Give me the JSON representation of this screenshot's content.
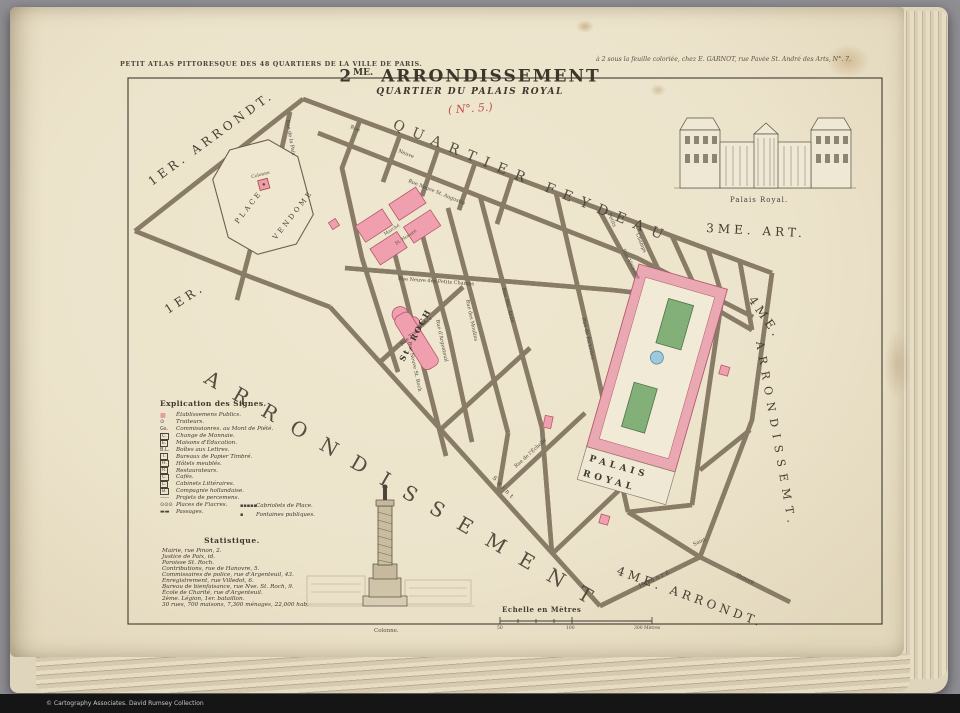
{
  "colors": {
    "paper": "#ece3cb",
    "building_pink": "#ef9fae",
    "garden_green": "#83b078",
    "basin_blue": "#9cc9dd",
    "annotation_red": "#c05050"
  },
  "photo": {
    "copyright": "© Cartography Associates. David Rumsey Collection"
  },
  "header": {
    "left": "PETIT ATLAS PITTORESQUE DES 48 QUARTIERS DE LA VILLE DE PARIS.",
    "right": "à 2 sous la feuille coloriée, chez E. GARNOT, rue Pavée St. André des Arts, N°. 7."
  },
  "title": {
    "num": "2",
    "sup": "ME.",
    "name": "ARRONDISSEMENT",
    "subtitle": "QUARTIER DU PALAIS ROYAL",
    "annotation": "( N°. 5.)"
  },
  "engravings": {
    "palais_caption": "Palais Royal.",
    "colonne_caption": "Colonne."
  },
  "map": {
    "district_labels": {
      "arr1_top": "1ER. ARRONDT.",
      "arr1_mid": "1ER.",
      "quartier": "QUARTIER FEYDEAU",
      "arr3": "3ME.  ART.",
      "arr4_num": "4ME.",
      "arr4_side": "ARRONDISSEMT.",
      "arr4_bottom": "4ME. ARRONDT.",
      "big": "ARRONDISSEMENT"
    },
    "places": {
      "place_vendome_1": "PLACE",
      "place_vendome_2": "VENDOME",
      "colonne": "Colonne",
      "marche_1": "Marché",
      "marche_2": "St. Honoré",
      "st_roch": "St. ROCH",
      "palais_1": "PALAIS",
      "palais_2": "ROYAL"
    },
    "street_labels": [
      {
        "t": "Rue de la Paix"
      },
      {
        "t": "Rue Neuve St. Augustin"
      },
      {
        "t": "Rue Neuve des Petits Champs"
      },
      {
        "t": "Rue de Richelieu"
      },
      {
        "t": "Rue Ste. Anne"
      },
      {
        "t": "Rue d'Argenteuil"
      },
      {
        "t": "Rue Neuve St. Roch"
      },
      {
        "t": "Rue des Moulins"
      },
      {
        "t": "Saint"
      },
      {
        "t": "Honoré"
      },
      {
        "t": "Rue"
      },
      {
        "t": "Neuve"
      },
      {
        "t": "Petits"
      },
      {
        "t": "Champs"
      },
      {
        "t": "Rue Vivienne"
      },
      {
        "t": "Rue de l'Échelle"
      },
      {
        "t": "Rue Traversière"
      },
      {
        "t": "Saint"
      },
      {
        "t": "Honoré"
      }
    ]
  },
  "legend": {
    "title": "Explication des Signes.",
    "items": [
      {
        "symbol": "■",
        "label": "Établissemens Publics."
      },
      {
        "symbol": "⊙",
        "label": "Traiteurs."
      },
      {
        "symbol": "Gs.",
        "label": "Commissionres. au Mont de Piété."
      },
      {
        "symbol": "C.",
        "label": "Change de Monnaie."
      },
      {
        "symbol": "E.",
        "label": "Maisons d'Éducation."
      },
      {
        "symbol": "B.L.",
        "label": "Boîtes aux Lettres."
      },
      {
        "symbol": "T.",
        "label": "Bureaux de Papier Timbré."
      },
      {
        "symbol": "H.",
        "label": "Hôtels meublés."
      },
      {
        "symbol": "R.",
        "label": "Restaurateurs."
      },
      {
        "symbol": "C.",
        "label": "Cafés."
      },
      {
        "symbol": "L.",
        "label": "Cabinets Littéraires."
      },
      {
        "symbol": "B.",
        "label": "Compagnie hollandaise."
      },
      {
        "symbol": "╌╌╌",
        "label": "Projets de percemens."
      },
      {
        "symbol": "⊙⊙⊙",
        "label": "Places de Fiacres."
      },
      {
        "symbol": "▬▬",
        "label": "Passages."
      }
    ],
    "extra": [
      {
        "symbol": "▪▪▪▪▪",
        "label": "Cabriolets de Place."
      },
      {
        "symbol": "▪",
        "label": "Fontaines publiques."
      }
    ]
  },
  "statistics": {
    "title": "Statistique.",
    "lines": [
      "Mairie, rue Pinon, 2.",
      "Justice de Paix, id.",
      "Paroisse St. Roch.",
      "Contributions, rue de Hanovre, 5.",
      "Commissaires de police, rue d'Argenteuil, 43.",
      "Enregistrement, rue Villedot, 6.",
      "Bureau de bienfaisance, rue Nve. St. Roch, 9.",
      "École de Charité, rue d'Argenteuil.",
      "2ème. Légion, 1er. bataillon.",
      "30 rues, 700 maisons, 7,300 ménages, 22,000 hab."
    ]
  },
  "scale": {
    "label": "Echelle en Mètres",
    "t1": "50",
    "t2": "100",
    "t3": "300 Mètres"
  }
}
